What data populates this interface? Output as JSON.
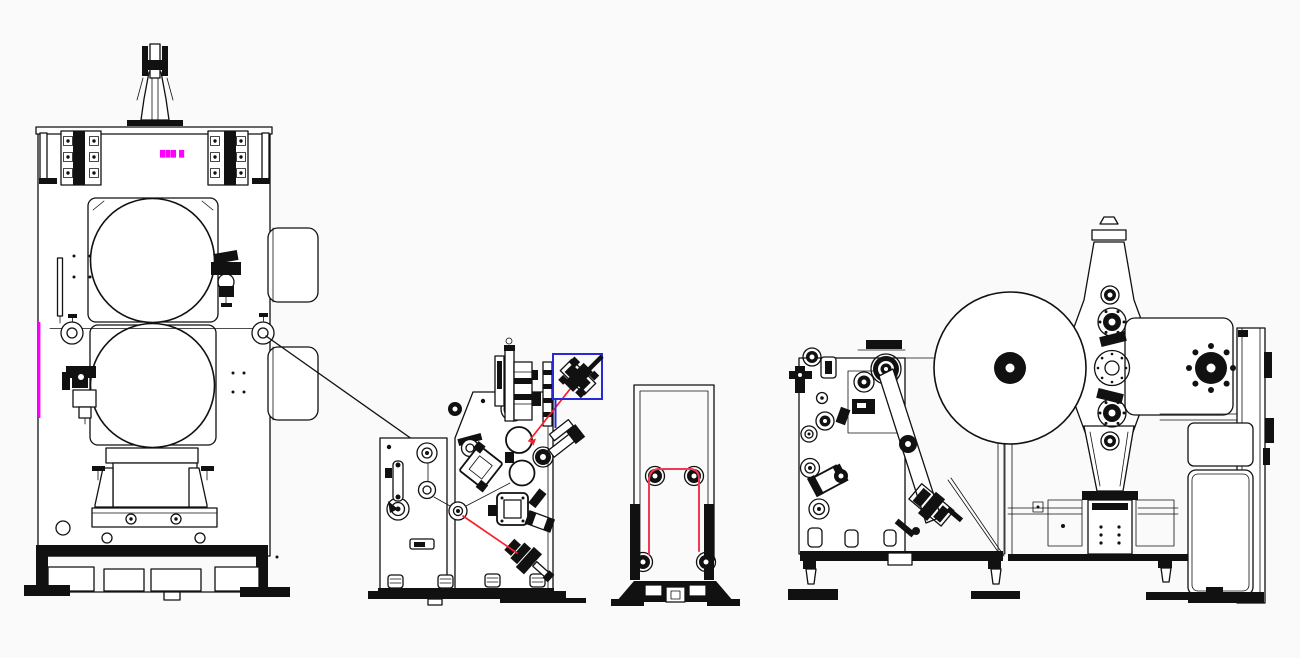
{
  "palette": {
    "bg": "#fafafa",
    "ink": "#111111",
    "fill": "#ffffff",
    "accent_red": "#f5202c",
    "path_red": "#ef3a55",
    "highlight_blue": "#2a2ad4",
    "accent_magenta": "#ff00ff"
  },
  "annotations": {
    "machine_tag": {
      "text": "███ █",
      "color": "#ff00ff"
    }
  }
}
